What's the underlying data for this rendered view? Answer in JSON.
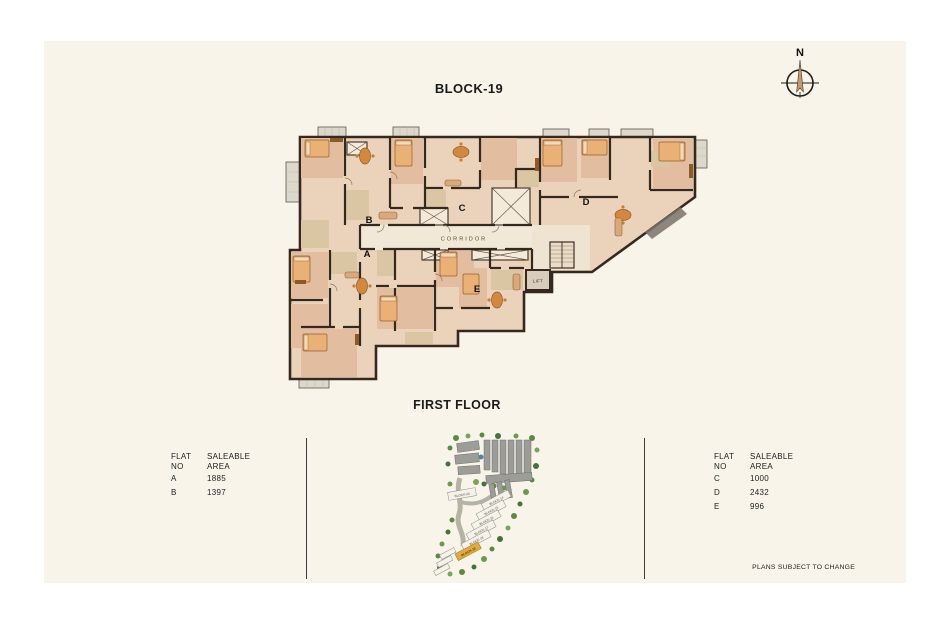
{
  "header": {
    "title": "BLOCK-19",
    "floor_title": "FIRST FLOOR"
  },
  "compass": {
    "north_label": "N"
  },
  "floor_plan": {
    "corridor_label": "CORRIDOR",
    "lift_label": "LIFT",
    "flats": {
      "a": "A",
      "b": "B",
      "c": "C",
      "d": "D",
      "e": "E"
    }
  },
  "area_tables": {
    "left": {
      "header": {
        "col1_line1": "FLAT",
        "col1_line2": "NO",
        "col2_line1": "SALEABLE",
        "col2_line2": "AREA"
      },
      "rows": [
        {
          "flat": "A",
          "area": "1885"
        },
        {
          "flat": "B",
          "area": "1397"
        }
      ]
    },
    "right": {
      "header": {
        "col1_line1": "FLAT",
        "col1_line2": "NO",
        "col2_line1": "SALEABLE",
        "col2_line2": "AREA"
      },
      "rows": [
        {
          "flat": "C",
          "area": "1000"
        },
        {
          "flat": "D",
          "area": "2432"
        },
        {
          "flat": "E",
          "area": "996"
        }
      ]
    }
  },
  "key_plan": {
    "highlighted_block": "BLOCK-19",
    "block_labels": [
      "BLOCK-20",
      "BLOCK-14",
      "BLOCK-15",
      "BLOCK-16",
      "BLOCK-17",
      "BLOCK-18",
      "BLOCK-19"
    ]
  },
  "footer": {
    "disclaimer": "PLANS SUBJECT TO CHANGE"
  },
  "colors": {
    "panel_bg": "#f8f4e9",
    "wall": "#35291f",
    "floor": "#ebd3bb",
    "room": "#e3bda0",
    "tile": "#dac6a2",
    "corridor": "#f2e8d7",
    "highlight": "#e2aa3e"
  }
}
